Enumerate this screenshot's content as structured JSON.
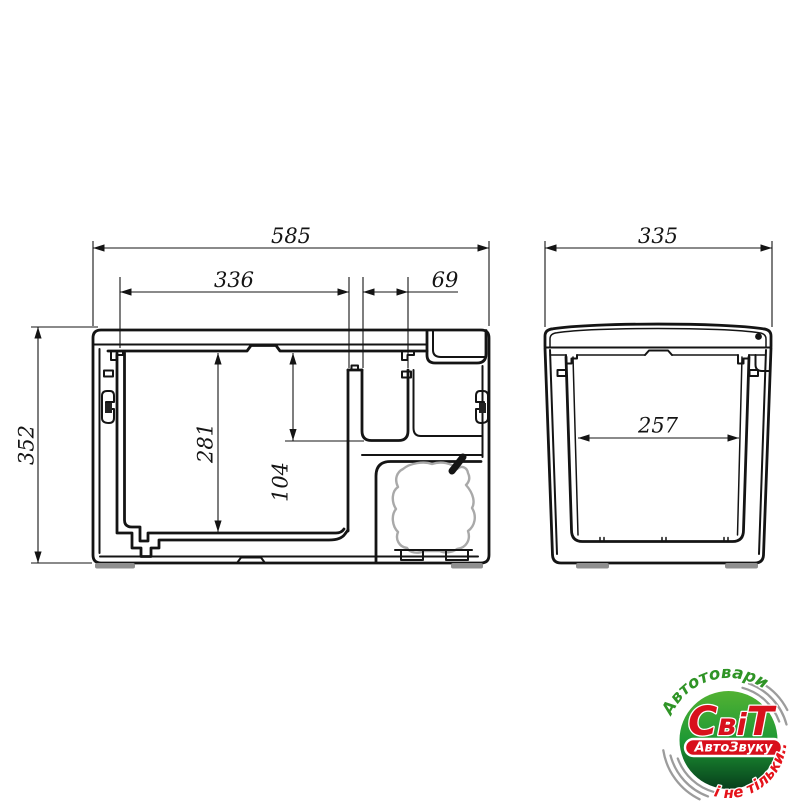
{
  "drawing": {
    "front_view": {
      "overall_width_mm": "585",
      "inner_width_mm": "336",
      "small_compartment_width_mm": "69",
      "overall_height_mm": "352",
      "main_compartment_depth_mm": "281",
      "small_compartment_depth_mm": "104"
    },
    "side_view": {
      "overall_depth_mm": "335",
      "inner_depth_mm": "257"
    },
    "line_color": "#141414"
  },
  "logo": {
    "arc_top_text": "Автотовари",
    "brand_parts": {
      "first": "С",
      "middle": "ві",
      "last": "Т"
    },
    "banner_text": "АвтоЗвуку",
    "arc_bottom_text": "і не тільки...",
    "colors": {
      "green_light": "#52b233",
      "green_mid": "#1e9934",
      "green_dark": "#073f1c",
      "text_green": "#2f9426",
      "red": "#d8101c",
      "red_bright": "#e5131a",
      "swoosh_gray": "#9c9c9c"
    }
  }
}
